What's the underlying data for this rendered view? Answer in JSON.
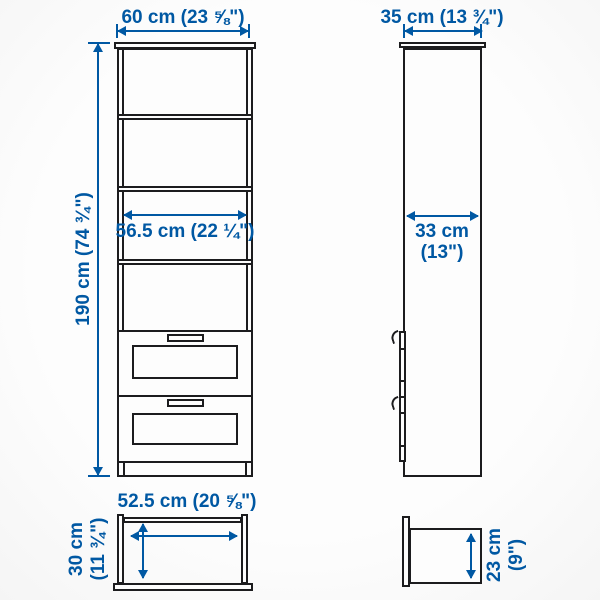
{
  "theme": {
    "accent": "#0058a3",
    "line": "#1c1c1e",
    "surface": "#fdfdfd",
    "background": "#fbfbfb"
  },
  "diagram": {
    "front_view": {
      "width_label": "60 cm (23 ⅝\")",
      "height_label": "190 cm (74 ¾\")",
      "shelf_width_label": "56.5 cm (22 ¼\")"
    },
    "side_view": {
      "depth_label": "35 cm (13 ¾\")",
      "inner_depth_line1": "33 cm",
      "inner_depth_line2": "(13\")"
    },
    "drawer_front_view": {
      "width_label": "52.5 cm (20 ⅝\")",
      "height_line1": "30 cm",
      "height_line2": "(11 ¾\")"
    },
    "drawer_side_view": {
      "depth_line1": "23 cm",
      "depth_line2": "(9\")"
    }
  }
}
